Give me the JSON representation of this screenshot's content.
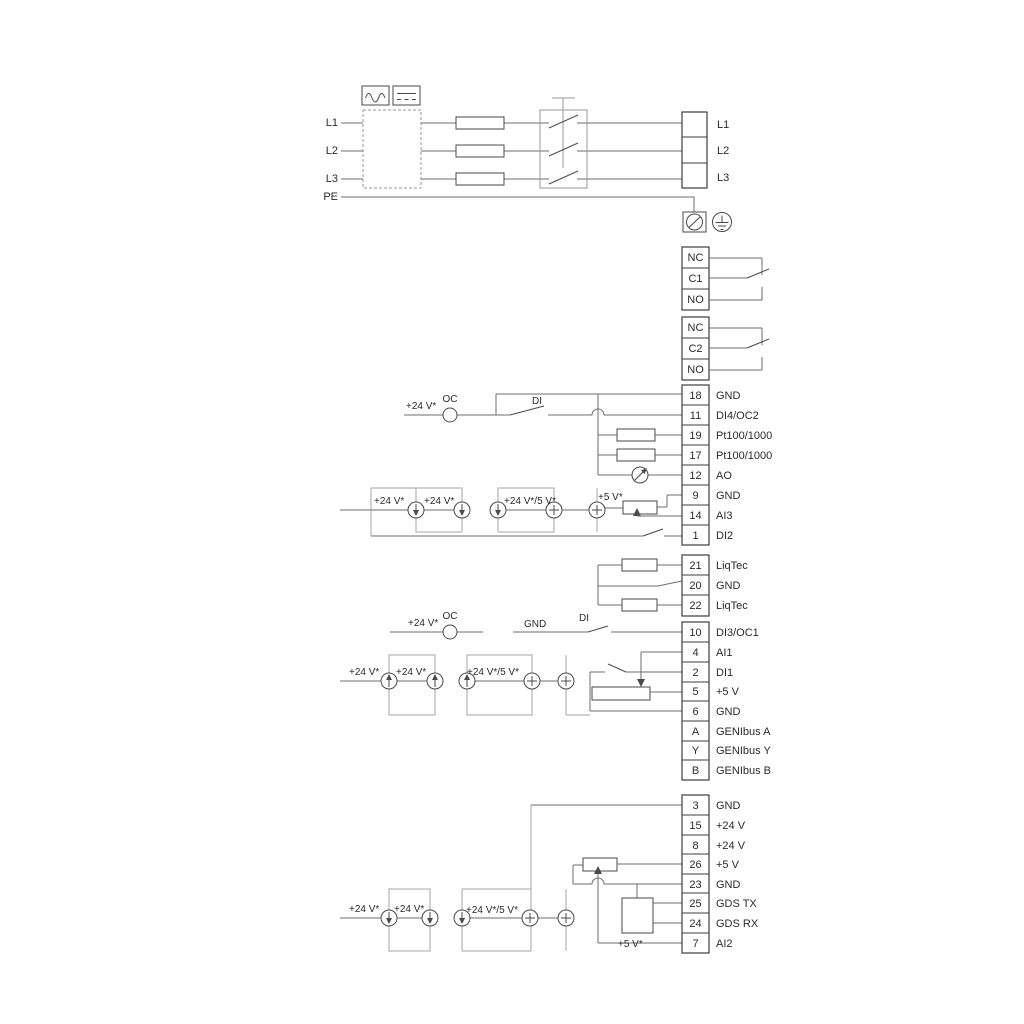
{
  "power": {
    "inputs": [
      "L1",
      "L2",
      "L3",
      "PE"
    ],
    "block": [
      "L1",
      "L2",
      "L3"
    ]
  },
  "relays": {
    "r1": [
      "NC",
      "C1",
      "NO"
    ],
    "r2": [
      "NC",
      "C2",
      "NO"
    ]
  },
  "groups": {
    "g1": [
      {
        "id": "18",
        "label": "GND"
      },
      {
        "id": "11",
        "label": "DI4/OC2"
      },
      {
        "id": "19",
        "label": "Pt100/1000"
      },
      {
        "id": "17",
        "label": "Pt100/1000"
      },
      {
        "id": "12",
        "label": "AO"
      },
      {
        "id": "9",
        "label": "GND"
      },
      {
        "id": "14",
        "label": "AI3"
      },
      {
        "id": "1",
        "label": "DI2"
      }
    ],
    "g2": [
      {
        "id": "21",
        "label": "LiqTec"
      },
      {
        "id": "20",
        "label": "GND"
      },
      {
        "id": "22",
        "label": "LiqTec"
      }
    ],
    "g3": [
      {
        "id": "10",
        "label": "DI3/OC1"
      },
      {
        "id": "4",
        "label": "AI1"
      },
      {
        "id": "2",
        "label": "DI1"
      },
      {
        "id": "5",
        "label": "+5 V"
      },
      {
        "id": "6",
        "label": "GND"
      },
      {
        "id": "A",
        "label": "GENIbus A"
      },
      {
        "id": "Y",
        "label": "GENIbus Y"
      },
      {
        "id": "B",
        "label": "GENIbus B"
      }
    ],
    "g4": [
      {
        "id": "3",
        "label": "GND"
      },
      {
        "id": "15",
        "label": "+24 V"
      },
      {
        "id": "8",
        "label": "+24 V"
      },
      {
        "id": "26",
        "label": "+5 V"
      },
      {
        "id": "23",
        "label": "GND"
      },
      {
        "id": "25",
        "label": "GDS TX"
      },
      {
        "id": "24",
        "label": "GDS RX"
      },
      {
        "id": "7",
        "label": "AI2"
      }
    ]
  },
  "annot": {
    "v24": "+24 V*",
    "v24v5": "+24 V*/5 V*",
    "v5": "+5 V*",
    "oc": "OC",
    "di": "DI",
    "gnd": "GND"
  },
  "icons": {
    "converter_left": "ac-waveform-icon",
    "converter_right": "dc-lines-icon",
    "ground_screw": "screw-terminal-icon",
    "earth": "earth-ground-icon",
    "current_source_down": "current-source-down-icon",
    "current_source_up": "current-source-up-icon",
    "current_source_plus": "current-source-plus-icon",
    "meter": "analog-output-meter-icon"
  },
  "colors": {
    "wire": "#6e6e6e",
    "dark": "#4a4a4a",
    "loop": "#b3b3b3",
    "strip_border": "#3c3c3c",
    "text": "#2b2b2b",
    "background": "#ffffff"
  }
}
